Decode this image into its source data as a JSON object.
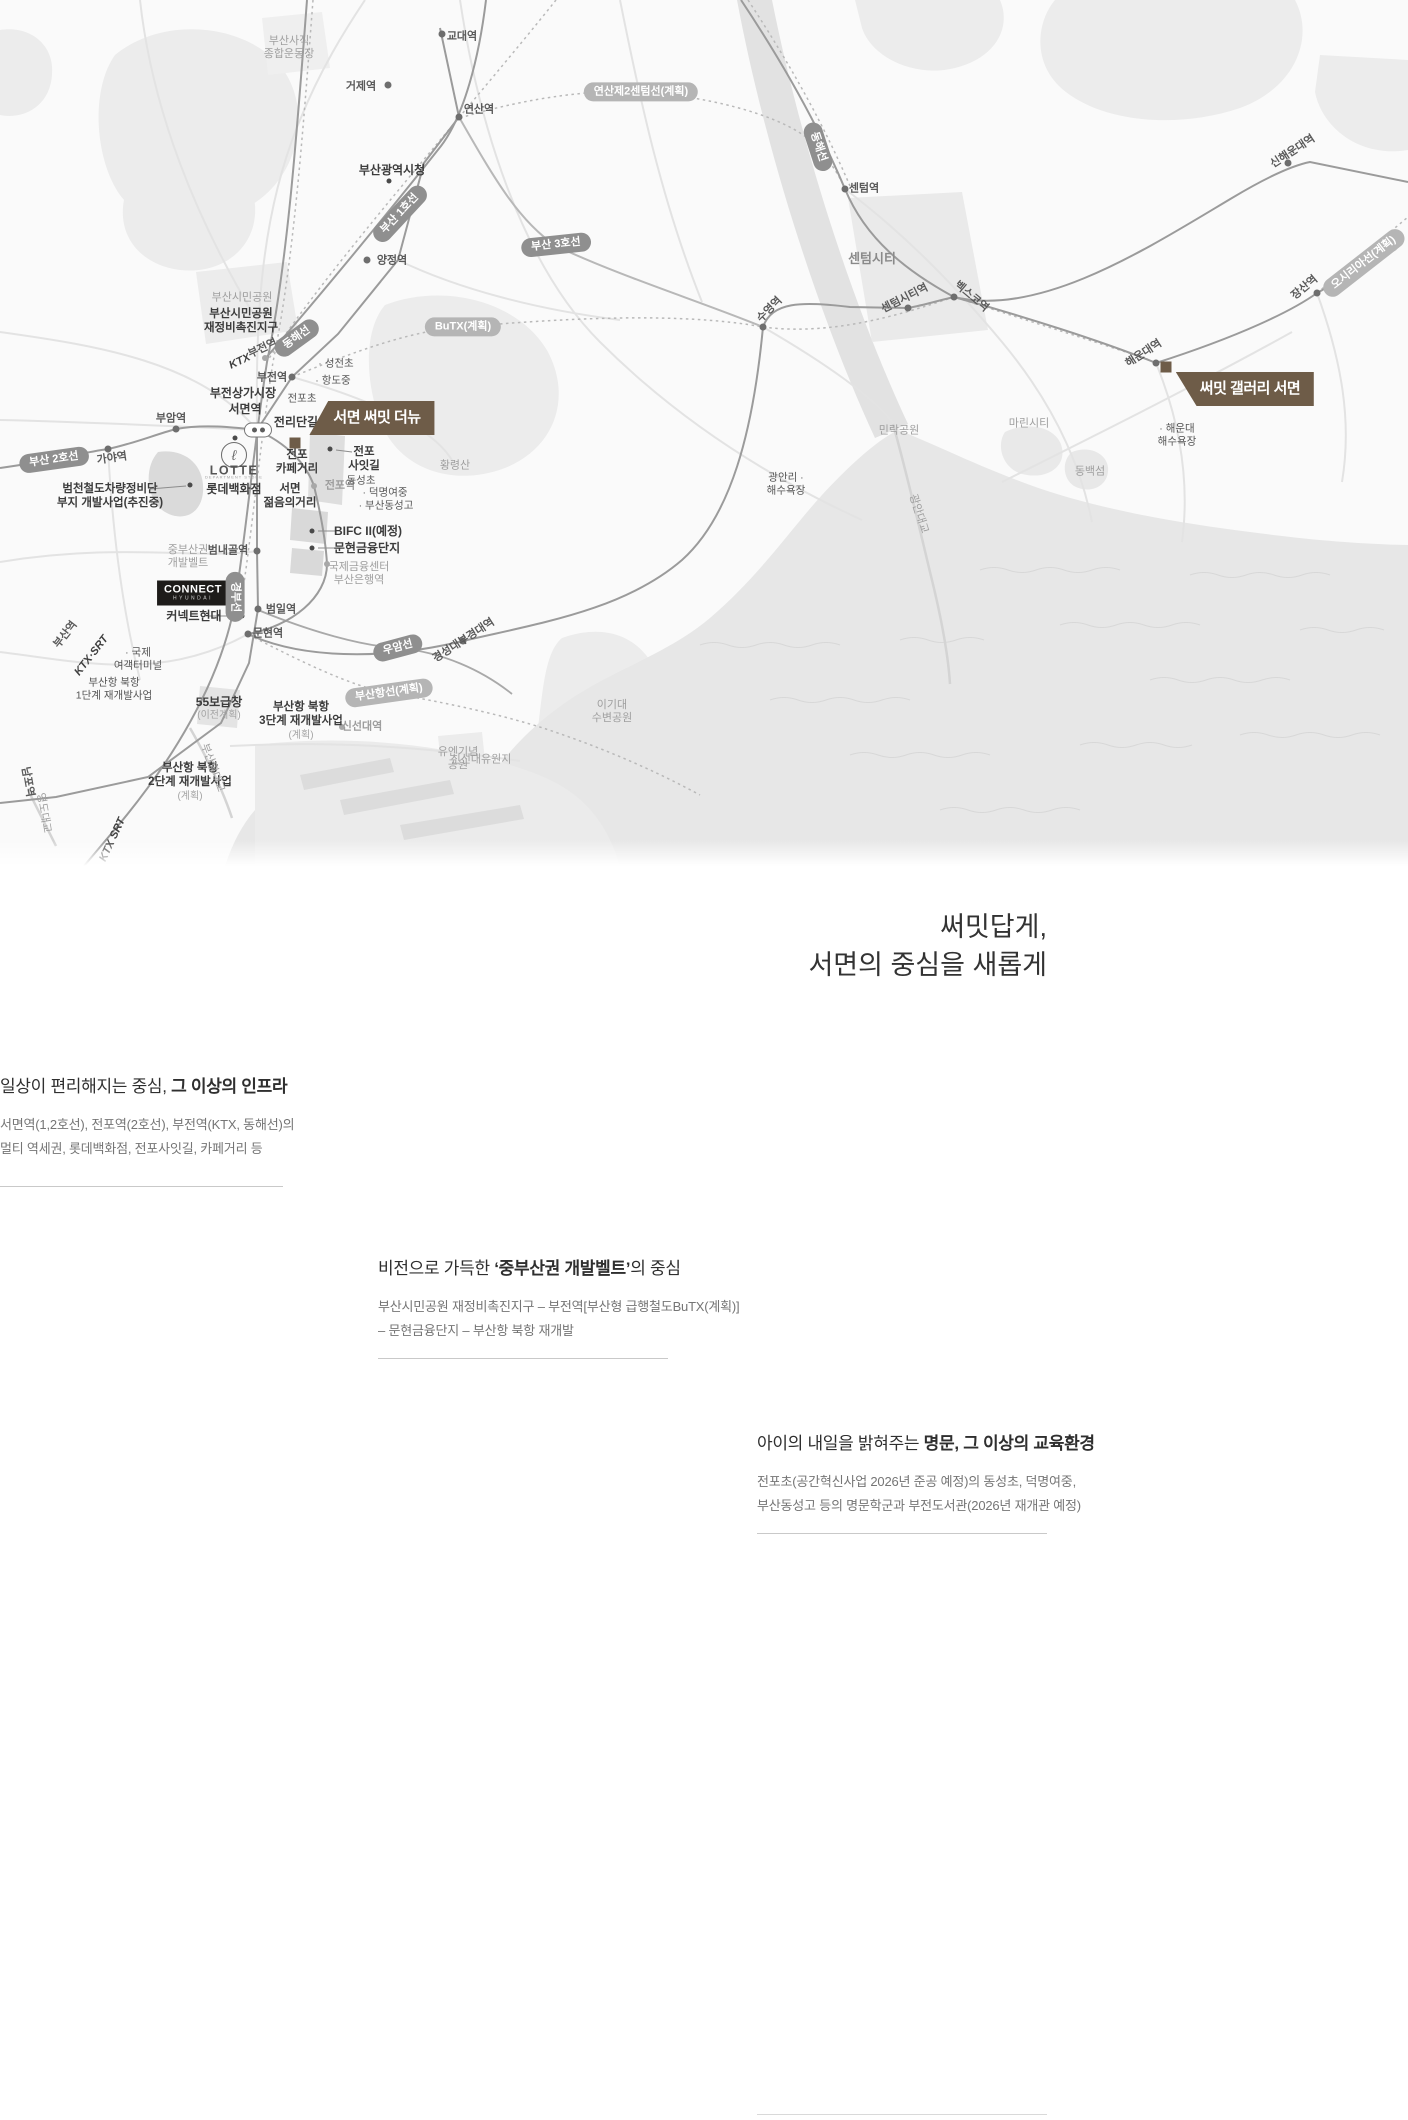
{
  "colors": {
    "brand_brown": "#6e5c48",
    "line_badge": "#8f8f8f",
    "planned_badge": "#b5b5b5",
    "rail": "#9b9b9b",
    "land": "#ededed",
    "sea": "#e7e7e7"
  },
  "map": {
    "labels": [
      {
        "t": "부산사직\n종합운동장",
        "x": 289,
        "y": 48,
        "type": "area-c"
      },
      {
        "t": "교대역",
        "x": 462,
        "y": 37,
        "type": "st"
      },
      {
        "t": "거제역",
        "x": 361,
        "y": 87,
        "type": "st"
      },
      {
        "t": "연산역",
        "x": 479,
        "y": 110,
        "type": "st"
      },
      {
        "t": "연산제2센텀선(계획)",
        "x": 641,
        "y": 92,
        "type": "badge-light"
      },
      {
        "t": "부산광역시청",
        "x": 392,
        "y": 170,
        "type": "st-b"
      },
      {
        "t": "부산 1호선",
        "x": 400,
        "y": 214,
        "type": "badge-dark",
        "rot": -47
      },
      {
        "t": "양정역",
        "x": 392,
        "y": 261,
        "type": "st"
      },
      {
        "t": "센텀역",
        "x": 864,
        "y": 189,
        "type": "st"
      },
      {
        "t": "센텀시티",
        "x": 872,
        "y": 259,
        "type": "area-b"
      },
      {
        "t": "부산 3호선",
        "x": 556,
        "y": 245,
        "type": "badge-dark",
        "rot": -6
      },
      {
        "t": "동해선",
        "x": 297,
        "y": 338,
        "type": "badge-dark",
        "rot": -36
      },
      {
        "t": "동해선",
        "x": 818,
        "y": 147,
        "type": "badge-dark",
        "rot": 72
      },
      {
        "t": "BuTX(계획)",
        "x": 463,
        "y": 327,
        "type": "badge-light"
      },
      {
        "t": "KTX",
        "x": 240,
        "y": 362,
        "type": "ktx",
        "rot": -25
      },
      {
        "t": "부전역",
        "x": 263,
        "y": 349,
        "type": "st",
        "rot": -25
      },
      {
        "t": "부전역",
        "x": 272,
        "y": 378,
        "type": "st"
      },
      {
        "t": "· 성전초",
        "x": 336,
        "y": 364,
        "type": "poi-s"
      },
      {
        "t": "· 항도중",
        "x": 333,
        "y": 381,
        "type": "poi-s"
      },
      {
        "t": "부전상가시장",
        "x": 243,
        "y": 393,
        "type": "st-b"
      },
      {
        "t": "전포초",
        "x": 302,
        "y": 399,
        "type": "poi-s"
      },
      {
        "t": "서면역",
        "x": 245,
        "y": 409,
        "type": "st-b"
      },
      {
        "t": "전리단길",
        "x": 296,
        "y": 422,
        "type": "st-b"
      },
      {
        "t": "서면 써밋 더뉴",
        "x": 372,
        "y": 418,
        "type": "flag-bl"
      },
      {
        "t": "부암역",
        "x": 171,
        "y": 419,
        "type": "st"
      },
      {
        "t": "가야역",
        "x": 112,
        "y": 459,
        "type": "st",
        "rot": -8
      },
      {
        "t": "부산 2호선",
        "x": 54,
        "y": 460,
        "type": "badge-dark",
        "rot": -8
      },
      {
        "t": "범천철도차량정비단\n부지 개발사업(추진중)",
        "x": 110,
        "y": 497,
        "type": "poi-c-b"
      },
      {
        "t": "ℓ",
        "x": 234,
        "y": 455,
        "type": "lotte-mark"
      },
      {
        "t": "LOTTE",
        "x": 234,
        "y": 471,
        "type": "lotte-word"
      },
      {
        "t": "DEPARTMENT STORE",
        "x": 234,
        "y": 478,
        "type": "lotte-tiny"
      },
      {
        "t": "롯데백화점",
        "x": 234,
        "y": 489,
        "type": "st-b"
      },
      {
        "t": "중부산권\n개발벨트",
        "x": 188,
        "y": 557,
        "type": "area-c"
      },
      {
        "t": "범내골역",
        "x": 228,
        "y": 551,
        "type": "st"
      },
      {
        "t": "CONNECT\nHYUNDAI",
        "x": 193,
        "y": 593,
        "type": "connect"
      },
      {
        "t": "커넥트현대",
        "x": 194,
        "y": 616,
        "type": "st-b"
      },
      {
        "t": "경부선",
        "x": 235,
        "y": 597,
        "type": "badge-dark",
        "rot": 90
      },
      {
        "t": "범일역",
        "x": 281,
        "y": 610,
        "type": "st"
      },
      {
        "t": "문현역",
        "x": 268,
        "y": 634,
        "type": "st"
      },
      {
        "t": "55보급창",
        "x": 219,
        "y": 702,
        "type": "st-b"
      },
      {
        "t": "(이전계획)",
        "x": 219,
        "y": 716,
        "type": "area-s"
      },
      {
        "t": "부산항 북항\n2단계 재개발사업",
        "x": 190,
        "y": 776,
        "type": "poi-c-b"
      },
      {
        "t": "(계획)",
        "x": 190,
        "y": 797,
        "type": "area-s"
      },
      {
        "t": "유엔기념\n공원",
        "x": 458,
        "y": 759,
        "type": "area-c"
      },
      {
        "t": "경성대부경대역",
        "x": 464,
        "y": 641,
        "type": "st",
        "rot": -33
      },
      {
        "t": "수영역",
        "x": 770,
        "y": 310,
        "type": "st",
        "rot": -45
      },
      {
        "t": "민락공원",
        "x": 899,
        "y": 431,
        "type": "area"
      },
      {
        "t": "광안리 ·\n해수욕장",
        "x": 786,
        "y": 484,
        "type": "poi-c"
      },
      {
        "t": "광안대교",
        "x": 918,
        "y": 514,
        "type": "area",
        "rot": 72
      },
      {
        "t": "센텀시티역",
        "x": 905,
        "y": 299,
        "type": "st",
        "rot": -27
      },
      {
        "t": "벡스코역",
        "x": 971,
        "y": 297,
        "type": "st",
        "rot": 40
      },
      {
        "t": "해운대역",
        "x": 1144,
        "y": 354,
        "type": "st",
        "rot": -33
      },
      {
        "t": "써밋 갤러리 서면",
        "x": 1245,
        "y": 389,
        "type": "flag-tl"
      },
      {
        "t": "· 해운대\n해수욕장",
        "x": 1177,
        "y": 435,
        "type": "poi-c"
      },
      {
        "t": "동백섬",
        "x": 1090,
        "y": 472,
        "type": "area"
      },
      {
        "t": "마린시티",
        "x": 1029,
        "y": 424,
        "type": "area"
      },
      {
        "t": "신해운대역",
        "x": 1293,
        "y": 152,
        "type": "st",
        "rot": -33
      },
      {
        "t": "장산역",
        "x": 1305,
        "y": 288,
        "type": "st",
        "rot": -40
      },
      {
        "t": "오시리아선(계획)",
        "x": 1364,
        "y": 263,
        "type": "badge-light",
        "rot": -38
      },
      {
        "t": "이기대\n수변공원",
        "x": 612,
        "y": 712,
        "type": "area-c"
      },
      {
        "t": "신선대유원지",
        "x": 481,
        "y": 760,
        "type": "area"
      },
      {
        "t": "신선대역",
        "x": 362,
        "y": 727,
        "type": "st-gray"
      },
      {
        "t": "우암선",
        "x": 398,
        "y": 648,
        "type": "badge-dark",
        "rot": -15
      },
      {
        "t": "부산항선(계획)",
        "x": 389,
        "y": 693,
        "type": "badge-light",
        "rot": -8
      },
      {
        "t": "부산항 북항\n3단계 재개발사업",
        "x": 301,
        "y": 715,
        "type": "poi-c-b"
      },
      {
        "t": "(계획)",
        "x": 301,
        "y": 736,
        "type": "area-s"
      },
      {
        "t": "· 국제\n여객터미널",
        "x": 138,
        "y": 659,
        "type": "poi-c"
      },
      {
        "t": "부산항 북항\n1단계 재개발사업",
        "x": 114,
        "y": 689,
        "type": "poi-c"
      },
      {
        "t": "부산역",
        "x": 66,
        "y": 635,
        "type": "st",
        "rot": -52
      },
      {
        "t": "KTX·SRT",
        "x": 92,
        "y": 656,
        "type": "ktx",
        "rot": -52
      },
      {
        "t": "KTX SRT",
        "x": 113,
        "y": 840,
        "type": "ktx",
        "rot": -65
      },
      {
        "t": "남포역",
        "x": 27,
        "y": 782,
        "type": "st",
        "rot": 80
      },
      {
        "t": "영도대교",
        "x": 43,
        "y": 813,
        "type": "area",
        "rot": 80
      },
      {
        "t": "부산항대교",
        "x": 212,
        "y": 768,
        "type": "area",
        "rot": 70
      },
      {
        "t": "황령산",
        "x": 455,
        "y": 466,
        "type": "area"
      },
      {
        "t": "전포역",
        "x": 340,
        "y": 486,
        "type": "st-gray"
      },
      {
        "t": "전포\n카페거리",
        "x": 297,
        "y": 463,
        "type": "poi-c-b"
      },
      {
        "t": "서면\n젊음의거리",
        "x": 290,
        "y": 497,
        "type": "poi-c-b"
      },
      {
        "t": "전포\n사잇길",
        "x": 364,
        "y": 460,
        "type": "poi-c-b"
      },
      {
        "t": "동성초",
        "x": 361,
        "y": 481,
        "type": "poi-s"
      },
      {
        "t": "· 덕명여중",
        "x": 385,
        "y": 493,
        "type": "poi-s"
      },
      {
        "t": "· 부산동성고",
        "x": 386,
        "y": 506,
        "type": "poi-s"
      },
      {
        "t": "BIFC II(예정)",
        "x": 368,
        "y": 531,
        "type": "st-b"
      },
      {
        "t": "문현금융단지",
        "x": 367,
        "y": 548,
        "type": "st-b"
      },
      {
        "t": "국제금융센터\n부산은행역",
        "x": 359,
        "y": 574,
        "type": "area-c"
      },
      {
        "t": "부산시민공원",
        "x": 242,
        "y": 298,
        "type": "area"
      },
      {
        "t": "부산시민공원\n재정비촉진지구",
        "x": 241,
        "y": 322,
        "type": "poi-c-b"
      },
      {
        "t": "",
        "x": 258,
        "y": 430,
        "type": "transfer"
      }
    ],
    "dots": [
      {
        "x": 442,
        "y": 34,
        "c": "d-st"
      },
      {
        "x": 388,
        "y": 85,
        "c": "d-st"
      },
      {
        "x": 459,
        "y": 117,
        "c": "d-st"
      },
      {
        "x": 367,
        "y": 260,
        "c": "d-st"
      },
      {
        "x": 845,
        "y": 189,
        "c": "d-st"
      },
      {
        "x": 292,
        "y": 377,
        "c": "d-st"
      },
      {
        "x": 176,
        "y": 429,
        "c": "d-st"
      },
      {
        "x": 108,
        "y": 449,
        "c": "d-st"
      },
      {
        "x": 257,
        "y": 551,
        "c": "d-st"
      },
      {
        "x": 258,
        "y": 609,
        "c": "d-st"
      },
      {
        "x": 248,
        "y": 634,
        "c": "d-st"
      },
      {
        "x": 463,
        "y": 641,
        "c": "d-st"
      },
      {
        "x": 763,
        "y": 327,
        "c": "d-st"
      },
      {
        "x": 908,
        "y": 308,
        "c": "d-st"
      },
      {
        "x": 954,
        "y": 297,
        "c": "d-st"
      },
      {
        "x": 1156,
        "y": 363,
        "c": "d-st"
      },
      {
        "x": 1317,
        "y": 293,
        "c": "d-st"
      },
      {
        "x": 1288,
        "y": 163,
        "c": "d-st"
      },
      {
        "x": 314,
        "y": 486,
        "c": "d-gy"
      },
      {
        "x": 327,
        "y": 564,
        "c": "d-gy"
      },
      {
        "x": 342,
        "y": 727,
        "c": "d-gy"
      },
      {
        "x": 265,
        "y": 358,
        "c": "d-gy"
      },
      {
        "x": 389,
        "y": 181,
        "c": "d-poi"
      },
      {
        "x": 235,
        "y": 438,
        "c": "d-poi"
      },
      {
        "x": 190,
        "y": 485,
        "c": "d-poi"
      },
      {
        "x": 242,
        "y": 616,
        "c": "d-poi"
      },
      {
        "x": 312,
        "y": 531,
        "c": "d-poi"
      },
      {
        "x": 312,
        "y": 548,
        "c": "d-poi"
      },
      {
        "x": 330,
        "y": 449,
        "c": "d-poi"
      },
      {
        "x": 295,
        "y": 443,
        "c": "d-sq"
      },
      {
        "x": 1166,
        "y": 367,
        "c": "d-sq"
      }
    ]
  },
  "content": {
    "headline": {
      "line1": "써밋답게,",
      "line2": "서면의 중심을 새롭게"
    },
    "sections": [
      {
        "title_pre": "일상이 편리해지는 중심, ",
        "title_bold": "그 이상의 인프라",
        "title_post": "",
        "body": [
          "서면역(1,2호선), 전포역(2호선), 부전역(KTX, 동해선)의",
          "멀티 역세권, 롯데백화점, 전포사잇길, 카페거리 등"
        ]
      },
      {
        "title_pre": "비전으로 가득한 ",
        "title_bold": "‘중부산권 개발벨트’",
        "title_post": "의 중심",
        "body": [
          "부산시민공원 재정비촉진지구 – 부전역[부산형 급행철도BuTX(계획)]",
          "– 문현금융단지 – 부산항 북항 재개발"
        ]
      },
      {
        "title_pre": "아이의 내일을 밝혀주는 ",
        "title_bold": "명문, 그 이상의 교육환경",
        "title_post": "",
        "body": [
          "전포초(공간혁신사업 2026년 준공 예정)의 동성초, 덕명여중,",
          "부산동성고 등의 명문학군과 부전도서관(2026년 재개관 예정)"
        ]
      }
    ]
  }
}
